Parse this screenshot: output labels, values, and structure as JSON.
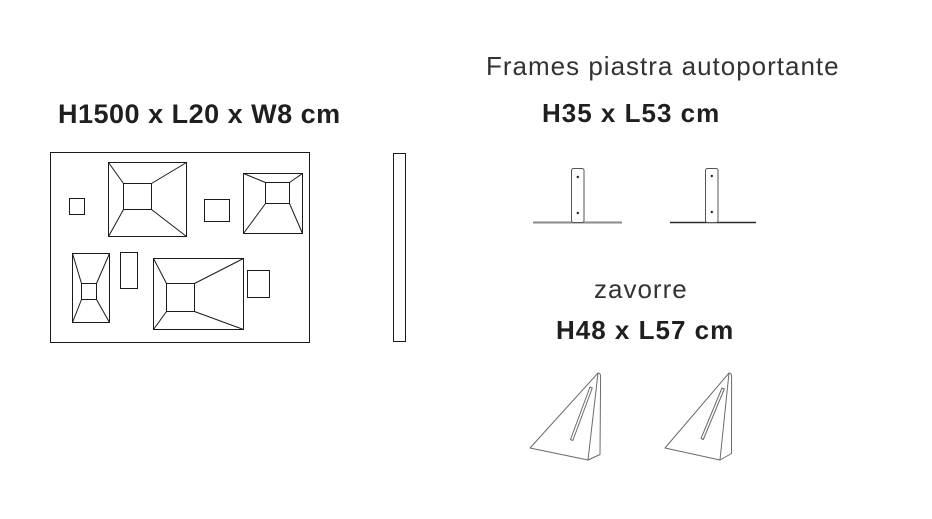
{
  "page": {
    "background_color": "#ffffff",
    "line_color": "#1a1a1a",
    "soft_line_color": "#6b6b6b",
    "text_color": "#222222"
  },
  "panel_section": {
    "dimensions_label": "H1500 x L20 x W8 cm",
    "views": [
      "front-view-with-relief-pyramids",
      "side-profile-view"
    ]
  },
  "frames_section": {
    "title": "Frames piastra autoportante",
    "dimensions_label": "H35 x L53 cm",
    "drawing": "two-t-shaped-base-plate-stands-with-screw-holes"
  },
  "zavorre_section": {
    "title": "zavorre",
    "dimensions_label": "H48 x L57 cm",
    "drawing": "two-triangular-wedge-ballast-weights-with-slot"
  }
}
